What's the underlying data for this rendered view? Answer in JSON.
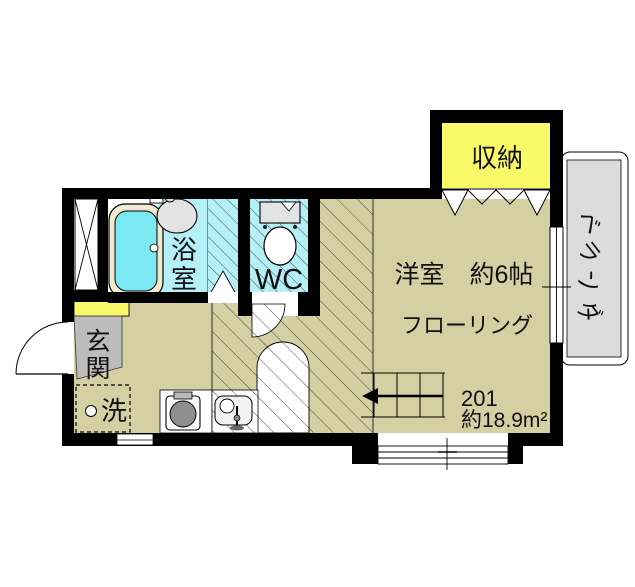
{
  "unit": {
    "number": "201",
    "area": "約18.9m²"
  },
  "rooms": {
    "storage": {
      "label": "収納"
    },
    "veranda": {
      "label": "ベランダ",
      "label_chars": [
        "ベ",
        "ラ",
        "ン",
        "ダ"
      ]
    },
    "bathroom": {
      "label": "浴室",
      "label_chars": [
        "浴",
        "室"
      ]
    },
    "toilet": {
      "label": "WC"
    },
    "western_room": {
      "size_label": "洋室　約6帖",
      "floor_label": "フローリング"
    },
    "entrance": {
      "label": "玄関",
      "label_chars": [
        "玄",
        "関"
      ]
    },
    "laundry": {
      "label": "洗"
    }
  },
  "colors": {
    "floor_tan": "#d5cfa4",
    "bath_cyan": "#b5eff7",
    "tub_water": "#7be8f2",
    "tub_rim": "#f1ebd0",
    "closet_yellow": "#fafa69",
    "genkan_gray": "#bcbcbc",
    "veranda_gray": "#dcdcdc",
    "fixture_gray": "#e3e3e3",
    "burner_gray": "#8e8e8e",
    "wall_black": "#000000"
  }
}
